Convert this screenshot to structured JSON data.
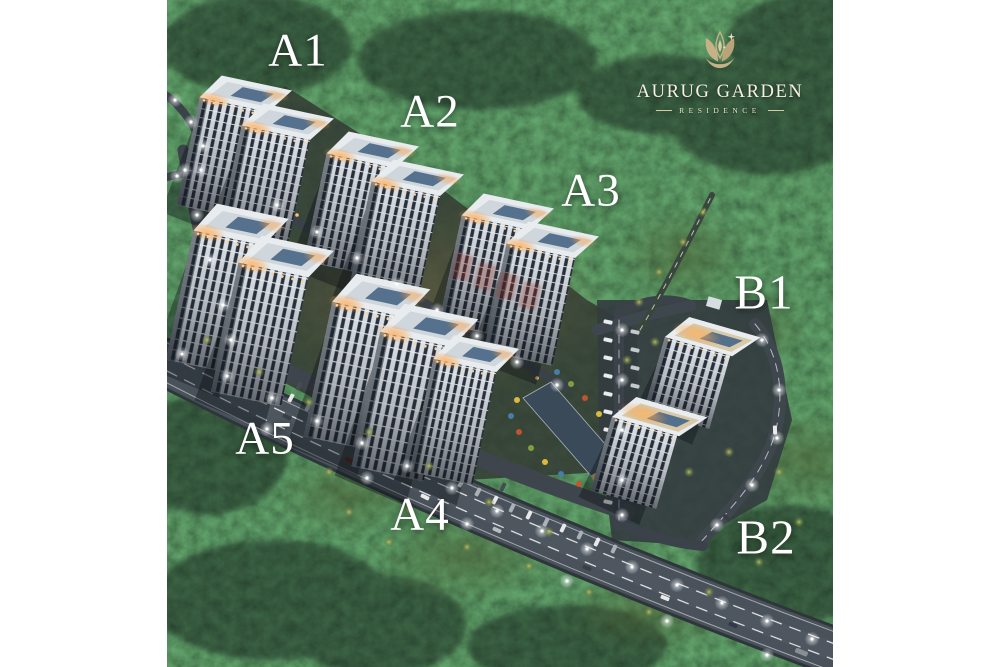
{
  "logo": {
    "title": "AURUG GARDEN",
    "subtitle": "RESIDENCE",
    "emblem_icon": "gold-tulip-leaf-emblem-icon",
    "gold": "#c7b287",
    "title_color": "#f5f1e4"
  },
  "block_labels": {
    "a1": "A1",
    "a2": "A2",
    "a3": "A3",
    "a4": "A4",
    "a5": "A5",
    "b1": "B1",
    "b2": "B2"
  },
  "scene": {
    "description": "Dusk aerial 3D render of the Aurug Garden Residence complex: seven labelled apartment blocks among dark forest, lit rooftops, boulevard with parked cars and streetlights, separate B1/B2 towers at lower right",
    "label_color": "#ffffff",
    "forest_green": "#203527",
    "road_gray": "#49525b",
    "tower_light": "#e2e7ea",
    "window_dark": "#2a323e",
    "roof_panel_blue": "#56718d",
    "roof_glow_orange": "#f0a95c",
    "watermark_red": "#a03028"
  }
}
